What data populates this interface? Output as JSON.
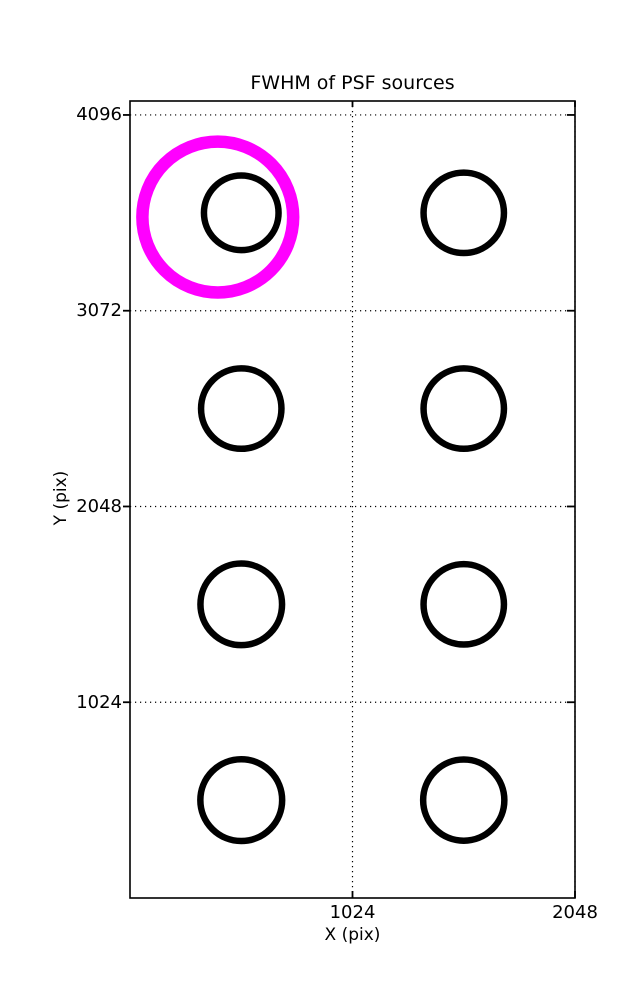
{
  "figure": {
    "background": "#ffffff",
    "text_color": "#000000"
  },
  "chart_data": {
    "type": "scatter",
    "title": "FWHM of PSF sources",
    "xlabel": "X (pix)",
    "ylabel": "Y (pix)",
    "xlim": [
      0,
      2048
    ],
    "ylim": [
      0,
      4169
    ],
    "xticks": [
      {
        "value": 1024,
        "label": "1024"
      },
      {
        "value": 2048,
        "label": "2048"
      }
    ],
    "yticks": [
      {
        "value": 1024,
        "label": "1024"
      },
      {
        "value": 2048,
        "label": "2048"
      },
      {
        "value": 3072,
        "label": "3072"
      },
      {
        "value": 4096,
        "label": "4096"
      }
    ],
    "grid": {
      "on": true,
      "style": "dotted",
      "color": "#000000"
    },
    "axes_color": "#000000",
    "marker_color": "#000000",
    "marker_stroke_px": 6.5,
    "sources": [
      {
        "x": 512,
        "y": 3584,
        "radius_px": 37.3
      },
      {
        "x": 1536,
        "y": 3584,
        "radius_px": 40.2
      },
      {
        "x": 512,
        "y": 2560,
        "radius_px": 40.2
      },
      {
        "x": 1536,
        "y": 2560,
        "radius_px": 40.2
      },
      {
        "x": 512,
        "y": 1536,
        "radius_px": 40.8
      },
      {
        "x": 1536,
        "y": 1536,
        "radius_px": 40.2
      },
      {
        "x": 512,
        "y": 512,
        "radius_px": 40.9
      },
      {
        "x": 1536,
        "y": 512,
        "radius_px": 40.6
      }
    ],
    "highlight": {
      "x": 404,
      "y": 3562,
      "radius_px": 75.4,
      "stroke_px": 12.5,
      "color": "#ff00ff"
    }
  }
}
